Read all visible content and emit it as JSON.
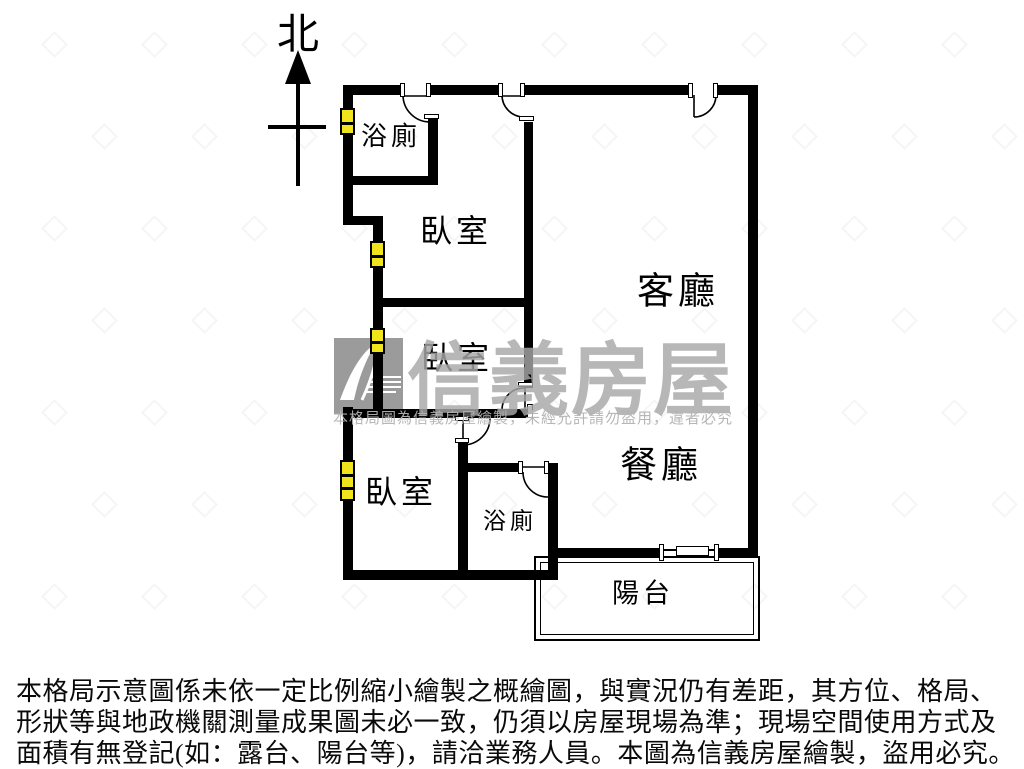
{
  "compass": {
    "label": "北"
  },
  "watermark": {
    "brand": "信義房屋",
    "logo": "sinyi-logo",
    "notice": "本格局圖為信義房屋繪製，未經允許請勿盜用，違者必究"
  },
  "rooms": [
    {
      "id": "bathroom-top",
      "label": "浴廁",
      "cx": 391,
      "cy": 137,
      "size": 26
    },
    {
      "id": "bedroom-1",
      "label": "臥室",
      "cx": 456,
      "cy": 231,
      "size": 32
    },
    {
      "id": "living-room",
      "label": "客廳",
      "cx": 678,
      "cy": 292,
      "size": 37
    },
    {
      "id": "bedroom-2",
      "label": "臥室",
      "cx": 457,
      "cy": 358,
      "size": 32
    },
    {
      "id": "bedroom-3",
      "label": "臥室",
      "cx": 401,
      "cy": 492,
      "size": 32
    },
    {
      "id": "bathroom-bottom",
      "label": "浴廁",
      "cx": 510,
      "cy": 521,
      "size": 23
    },
    {
      "id": "dining-room",
      "label": "餐廳",
      "cx": 661,
      "cy": 466,
      "size": 37
    },
    {
      "id": "balcony",
      "label": "陽台",
      "cx": 643,
      "cy": 594,
      "size": 27
    }
  ],
  "disclaimer": {
    "lines": [
      "本格局示意圖係未依一定比例縮小繪製之概繪圖，與實況仍有差距，其方位、格局、",
      "形狀等與地政機關測量成果圖未必一致，仍須以房屋現場為準；現場空間使用方式及",
      "面積有無登記(如：露台、陽台等)，請洽業務人員。本圖為信義房屋繪製，盜用必究。"
    ]
  },
  "floorplan": {
    "wall_color": "#000000",
    "window_fill": "#f0e41c",
    "walls": [
      {
        "name": "top-wall-a",
        "x": 343,
        "y": 85,
        "w": 60,
        "h": 10
      },
      {
        "name": "top-wall-b",
        "x": 430,
        "y": 85,
        "w": 72,
        "h": 10
      },
      {
        "name": "top-wall-c",
        "x": 524,
        "y": 85,
        "w": 166,
        "h": 10
      },
      {
        "name": "top-wall-d",
        "x": 716,
        "y": 85,
        "w": 42,
        "h": 10
      },
      {
        "name": "bath1-bottom-wall",
        "x": 343,
        "y": 176,
        "w": 95,
        "h": 9
      },
      {
        "name": "left-jog-wall",
        "x": 343,
        "y": 216,
        "w": 40,
        "h": 9
      },
      {
        "name": "bedroom-divider",
        "x": 375,
        "y": 298,
        "w": 158,
        "h": 9
      },
      {
        "name": "bed2-bottom-wall",
        "x": 343,
        "y": 409,
        "w": 190,
        "h": 9
      },
      {
        "name": "bath2-top-wall",
        "x": 463,
        "y": 463,
        "w": 60,
        "h": 9
      },
      {
        "name": "dining-bottom-a",
        "x": 548,
        "y": 548,
        "w": 116,
        "h": 10
      },
      {
        "name": "dining-bottom-b",
        "x": 716,
        "y": 548,
        "w": 42,
        "h": 10
      },
      {
        "name": "unit-bottom-wall",
        "x": 343,
        "y": 570,
        "w": 215,
        "h": 10
      },
      {
        "name": "left-wall-a",
        "x": 343,
        "y": 85,
        "w": 10,
        "h": 140
      },
      {
        "name": "left-wall-b",
        "x": 373,
        "y": 216,
        "w": 10,
        "h": 199
      },
      {
        "name": "left-wall-c",
        "x": 343,
        "y": 407,
        "w": 10,
        "h": 173
      },
      {
        "name": "bath1-right-wall",
        "x": 428,
        "y": 118,
        "w": 10,
        "h": 67
      },
      {
        "name": "central-wall",
        "x": 524,
        "y": 122,
        "w": 9,
        "h": 266
      },
      {
        "name": "right-wall",
        "x": 748,
        "y": 85,
        "w": 10,
        "h": 473
      },
      {
        "name": "bath2-left-wall",
        "x": 458,
        "y": 443,
        "w": 10,
        "h": 137
      },
      {
        "name": "bath2-right-wall",
        "x": 548,
        "y": 463,
        "w": 10,
        "h": 117
      }
    ],
    "windows": [
      {
        "x": 340,
        "y": 108,
        "w": 15,
        "h": 27,
        "panes": 2
      },
      {
        "x": 370,
        "y": 241,
        "w": 15,
        "h": 27,
        "panes": 2
      },
      {
        "x": 370,
        "y": 328,
        "w": 15,
        "h": 26,
        "panes": 2
      },
      {
        "x": 340,
        "y": 460,
        "w": 15,
        "h": 41,
        "panes": 3
      }
    ],
    "jambs": [
      {
        "x": 400,
        "y": 83,
        "w": 5,
        "h": 14
      },
      {
        "x": 426,
        "y": 83,
        "w": 5,
        "h": 14
      },
      {
        "x": 498,
        "y": 83,
        "w": 5,
        "h": 14
      },
      {
        "x": 520,
        "y": 83,
        "w": 5,
        "h": 14
      },
      {
        "x": 688,
        "y": 83,
        "w": 5,
        "h": 15
      },
      {
        "x": 713,
        "y": 83,
        "w": 5,
        "h": 15
      },
      {
        "x": 424,
        "y": 114,
        "w": 15,
        "h": 5
      },
      {
        "x": 519,
        "y": 116,
        "w": 15,
        "h": 5
      },
      {
        "x": 518,
        "y": 382,
        "w": 15,
        "h": 5
      },
      {
        "x": 527,
        "y": 404,
        "w": 6,
        "h": 14
      },
      {
        "x": 455,
        "y": 416,
        "w": 14,
        "h": 5
      },
      {
        "x": 455,
        "y": 438,
        "w": 14,
        "h": 5
      },
      {
        "x": 518,
        "y": 461,
        "w": 5,
        "h": 13
      },
      {
        "x": 544,
        "y": 461,
        "w": 5,
        "h": 13
      },
      {
        "x": 659,
        "y": 544,
        "w": 5,
        "h": 17
      },
      {
        "x": 714,
        "y": 544,
        "w": 5,
        "h": 17
      }
    ],
    "doors": [
      {
        "name": "bath1-door",
        "arc": "M403 95 A27 27 0 0 0 430 122",
        "leaf": "M403 96 L430 96"
      },
      {
        "name": "bedroom1-door",
        "arc": "M502 95 A22 22 0 0 0 524 117",
        "leaf": "M502 96 L524 96"
      },
      {
        "name": "entrance-door",
        "arc": "M694 117 A22 22 0 0 0 716 95",
        "leaf": "M694 95 L694 117"
      },
      {
        "name": "bedroom2-door",
        "arc": "M524 388 A22 22 0 0 0 502 410",
        "leaf": "M525 388 L525 410"
      },
      {
        "name": "bedroom3-door",
        "arc": "M463 445 A27 27 0 0 0 490 418",
        "leaf": "M463 419 L463 445"
      },
      {
        "name": "bath2-door",
        "arc": "M523 472 A25 25 0 0 0 548 497",
        "leaf": "M523 467 L548 467"
      }
    ],
    "balcony": {
      "x": 534,
      "y": 556,
      "w": 226,
      "h": 85
    },
    "slider": {
      "track": {
        "x": 664,
        "y": 549,
        "w": 52,
        "h": 2
      },
      "panel": {
        "x": 676,
        "y": 546,
        "w": 33,
        "h": 10
      }
    }
  }
}
